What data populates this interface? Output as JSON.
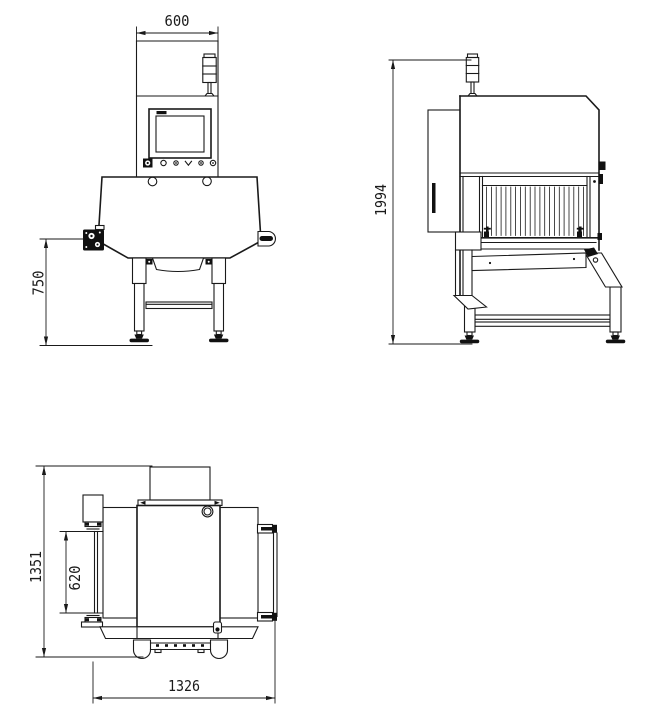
{
  "dimensions": {
    "front_width": "600",
    "front_conveyor_height": "750",
    "side_overall_height": "1994",
    "top_overall_depth": "1351",
    "top_belt_width": "620",
    "top_overall_length": "1326"
  },
  "colors": {
    "line": "#1a1a1a",
    "dark_fill": "#111111",
    "background": "#ffffff"
  }
}
